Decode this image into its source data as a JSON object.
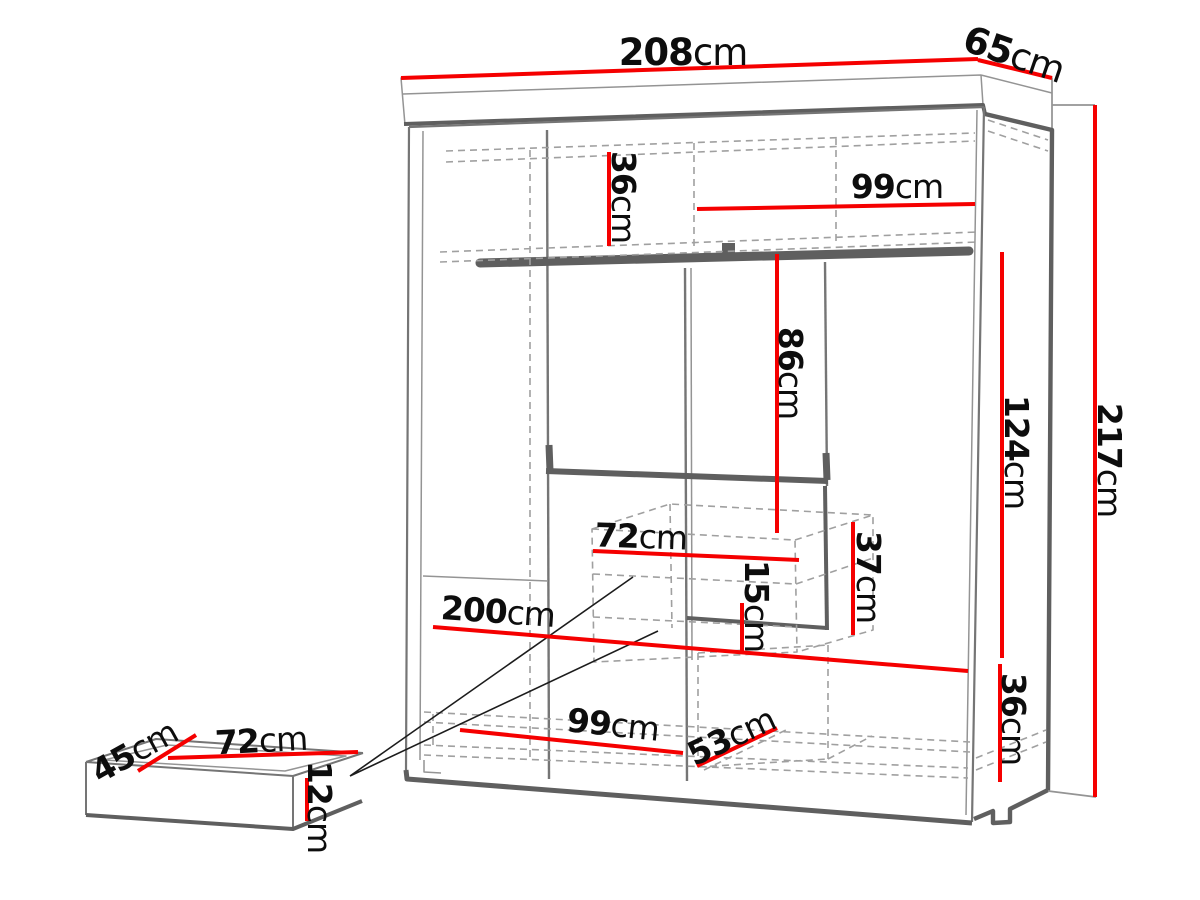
{
  "diagram": {
    "title": "Wardrobe dimensions diagram",
    "unit": "cm",
    "colors": {
      "dimension": "#f50000",
      "outline_strong": "#5f5f5f",
      "outline_med": "#757575",
      "outline_light": "#949494",
      "hidden": "#a0a0a0",
      "callout": "#1c1c1c",
      "label": "#0d0d0d",
      "background": "#ffffff"
    },
    "wardrobe": {
      "width": {
        "value": "208",
        "unit": "cm"
      },
      "depth": {
        "value": "65",
        "unit": "cm"
      },
      "height": {
        "value": "217",
        "unit": "cm"
      },
      "top_shelf_height": {
        "value": "36",
        "unit": "cm"
      },
      "top_shelf_width": {
        "value": "99",
        "unit": "cm"
      },
      "hanging_height": {
        "value": "86",
        "unit": "cm"
      },
      "right_section_height": {
        "value": "124",
        "unit": "cm"
      },
      "drawer_width": {
        "value": "72",
        "unit": "cm"
      },
      "drawer_unit_height": {
        "value": "37",
        "unit": "cm"
      },
      "drawer_front_height": {
        "value": "15",
        "unit": "cm"
      },
      "interior_width": {
        "value": "200",
        "unit": "cm"
      },
      "bottom_left_width": {
        "value": "99",
        "unit": "cm"
      },
      "bottom_right_width": {
        "value": "53",
        "unit": "cm"
      },
      "bottom_height": {
        "value": "36",
        "unit": "cm"
      }
    },
    "drawer": {
      "depth": {
        "value": "45",
        "unit": "cm"
      },
      "width": {
        "value": "72",
        "unit": "cm"
      },
      "height": {
        "value": "12",
        "unit": "cm"
      }
    }
  }
}
